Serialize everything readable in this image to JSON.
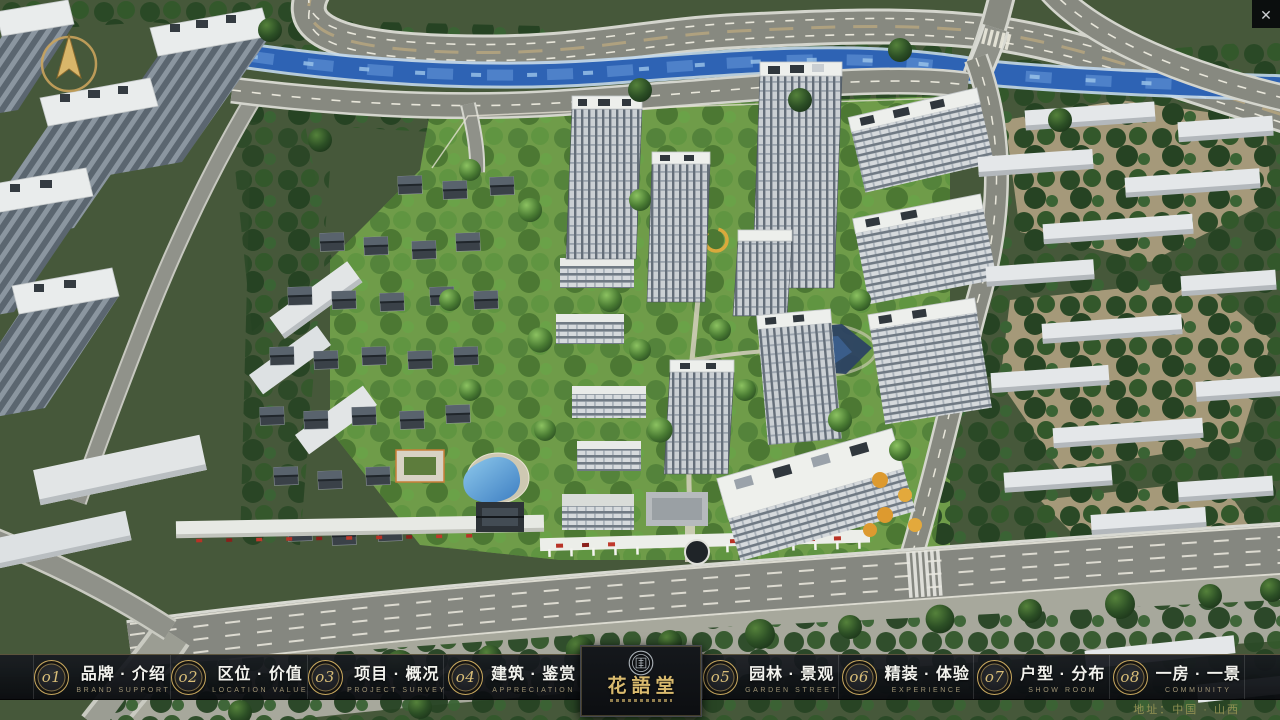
{
  "window": {
    "close_glyph": "✕"
  },
  "logo": {
    "title": "花語堂"
  },
  "nav": {
    "items": [
      {
        "num": "o1",
        "label": "品牌 · 介绍",
        "sub": "BRAND SUPPORT"
      },
      {
        "num": "o2",
        "label": "区位 · 价值",
        "sub": "LOCATION VALUE"
      },
      {
        "num": "o3",
        "label": "项目 · 概况",
        "sub": "PROJECT SURVEY"
      },
      {
        "num": "o4",
        "label": "建筑 · 鉴赏",
        "sub": "APPRECIATION"
      },
      {
        "num": "o5",
        "label": "园林 · 景观",
        "sub": "GARDEN STREET"
      },
      {
        "num": "o6",
        "label": "精装 · 体验",
        "sub": "EXPERIENCE"
      },
      {
        "num": "o7",
        "label": "户型 · 分布",
        "sub": "SHOW ROOM"
      },
      {
        "num": "o8",
        "label": "一房 · 一景",
        "sub": "COMMUNITY"
      }
    ]
  },
  "footer": {
    "address": "地址：中国 · 山西"
  },
  "colors": {
    "accent_gold": "#c9a35c",
    "nav_background": "#14161b",
    "river_blue": "#2f66b8",
    "site_green": "#6f9c49"
  }
}
